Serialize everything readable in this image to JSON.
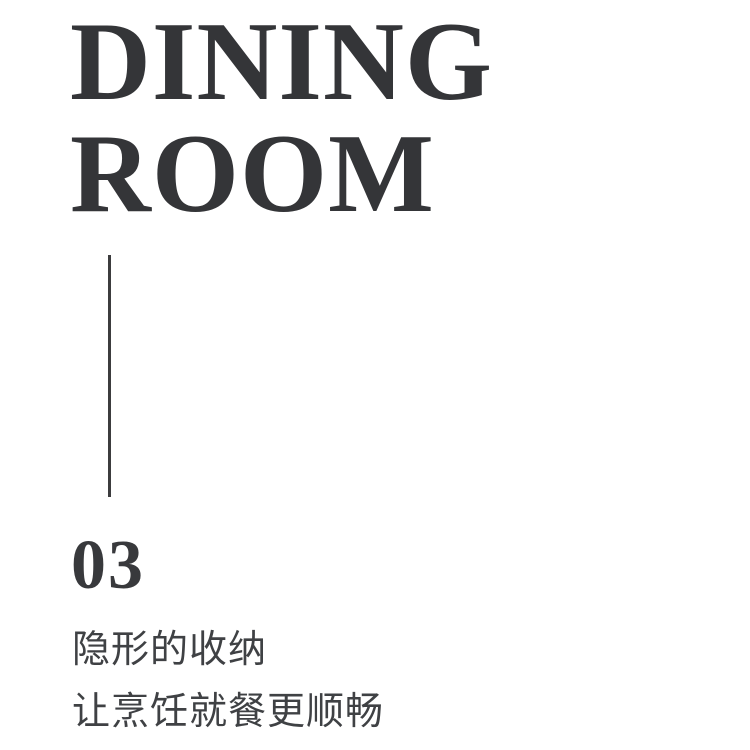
{
  "poster": {
    "title": {
      "line1": "DINING",
      "line2": "ROOM"
    },
    "section_number": "03",
    "subtitle": {
      "line1": "隐形的收纳",
      "line2": "让烹饪就餐更顺畅"
    },
    "colors": {
      "background": "#ffffff",
      "title": "#343538",
      "number": "#38393c",
      "subtitle": "#3f4144",
      "divider": "#3c3c3e"
    }
  }
}
